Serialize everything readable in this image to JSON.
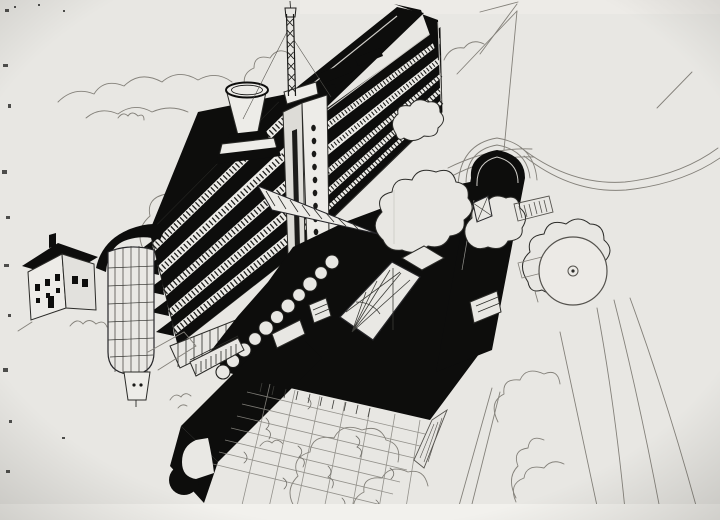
{
  "artwork": {
    "kind": "Scanned black-ink aerial perspective drawing of a constructivist building complex with slab block, radio mast, rounded-end wing, round pond and gardens",
    "visible_text": "",
    "colors": {
      "paper": "#e8e7e3",
      "paper_bright": "#f2f1ed",
      "ink": "#0d0d0c",
      "outline": "#2b2b28",
      "mid": "#55534e",
      "pencil": "#84817a",
      "light_on_black": "#cfcdc8",
      "facade_white": "#edece8"
    },
    "elements": {
      "slab": "long slab building with ribbon windows and black roof",
      "mast": "lattice radio mast on roof",
      "funnel": "funnel-shaped rooftop tower",
      "stair_tower": "service tower with porthole windows",
      "cylinder": "rounded glass stair tower at west end",
      "house": "small gabled annex house",
      "wing": "black-roofed low wing with rounded end",
      "courtyard": "skylight courtyard in black roof",
      "pond": "circular pond with central fountain",
      "garden": "gridded parterre garden",
      "hook": "curved ramp end of terrace wing"
    }
  }
}
